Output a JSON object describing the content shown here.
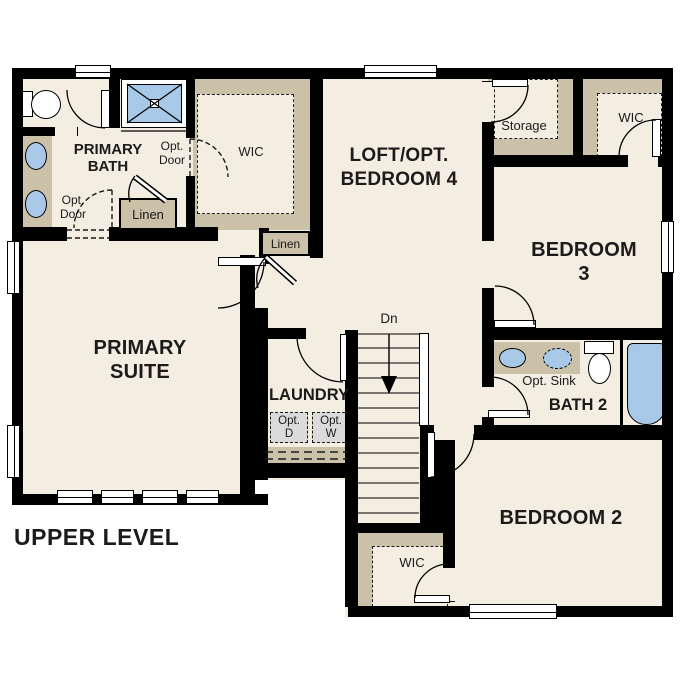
{
  "plan_title": "UPPER LEVEL",
  "labels": {
    "primary_bath": "PRIMARY\nBATH",
    "primary_suite": "PRIMARY\nSUITE",
    "loft_bedroom4": "LOFT/OPT.\nBEDROOM 4",
    "bedroom3": "BEDROOM 3",
    "bedroom2": "BEDROOM 2",
    "bath2": "BATH 2",
    "laundry": "LAUNDRY",
    "storage": "Storage",
    "wic_primary": "WIC",
    "wic_bedroom3": "WIC",
    "wic_bedroom2": "WIC",
    "linen_bath": "Linen",
    "linen_hall": "Linen",
    "opt_door_wic": "Opt.\nDoor",
    "opt_door_suite": "Opt.\nDoor",
    "opt_sink": "Opt. Sink",
    "opt_dryer": "Opt.\nD",
    "opt_washer": "Opt.\nW",
    "stairs_down": "Dn"
  },
  "colors": {
    "wall": "#000000",
    "floor": "#F4EDE1",
    "millwork": "#CBC0A8",
    "fixture_blue": "#A7C9E7",
    "opt_appliance": "#DBDBDB",
    "background": "#FFFFFF"
  }
}
